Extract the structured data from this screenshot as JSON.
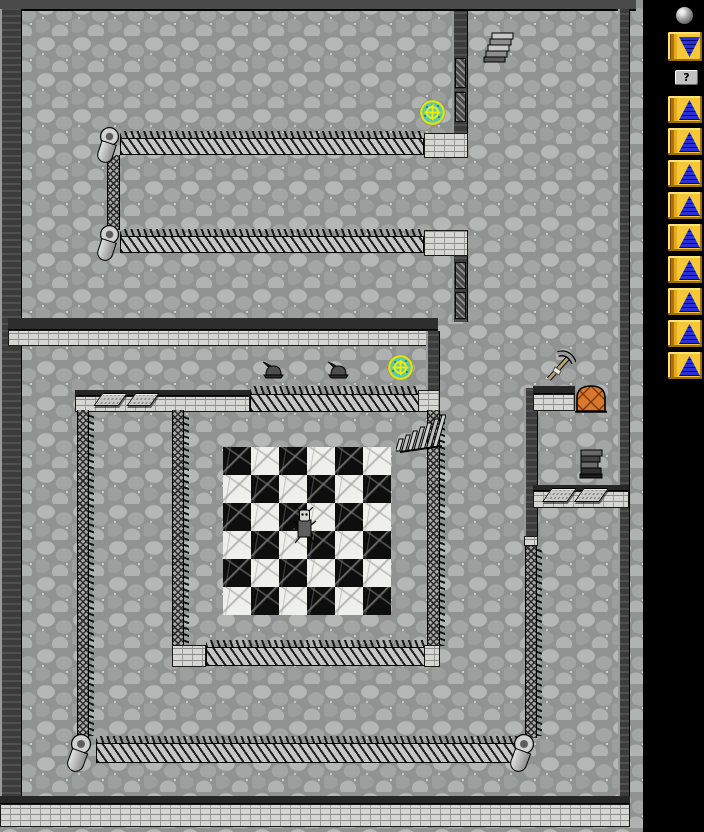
{
  "window": {
    "canvas_w": 704,
    "canvas_h": 832,
    "background": "#000000"
  },
  "sidebar": {
    "orb_icon": "stone-orb-icon",
    "descend_button": {
      "icon": "pyramid-down-icon"
    },
    "help_button": {
      "label": "?"
    },
    "spell_buttons": [
      {
        "icon": "pyramid-up-icon"
      },
      {
        "icon": "pyramid-up-icon"
      },
      {
        "icon": "pyramid-up-icon"
      },
      {
        "icon": "pyramid-up-icon"
      },
      {
        "icon": "pyramid-up-icon"
      },
      {
        "icon": "pyramid-up-icon"
      },
      {
        "icon": "pyramid-up-icon"
      },
      {
        "icon": "pyramid-up-icon"
      },
      {
        "icon": "pyramid-up-icon"
      }
    ]
  },
  "map": {
    "floor_texture": "cobblestone",
    "checkerboard": {
      "cols": 6,
      "rows": 6,
      "tile_px": 28,
      "first_tile": "black",
      "tile_colors": {
        "black": "#0e0e0e",
        "white": "#efefec"
      }
    },
    "items": [
      {
        "type": "stairs-down",
        "area": "top-right"
      },
      {
        "type": "portal-rune",
        "area": "upper-room"
      },
      {
        "type": "portal-rune",
        "area": "mid-corridor"
      },
      {
        "type": "helmet",
        "area": "mid-corridor-west"
      },
      {
        "type": "helmet",
        "area": "mid-corridor-east"
      },
      {
        "type": "ladder-up",
        "area": "inner-room-northeast"
      },
      {
        "type": "creature",
        "area": "checkerboard-center"
      },
      {
        "type": "pickaxe",
        "area": "east-room"
      },
      {
        "type": "wooden-door",
        "area": "east-room"
      },
      {
        "type": "dark-stairs",
        "area": "east-room"
      },
      {
        "type": "plate",
        "area": "west-wall-top-1"
      },
      {
        "type": "plate",
        "area": "west-wall-top-2"
      },
      {
        "type": "plate",
        "area": "east-wall-1"
      },
      {
        "type": "plate",
        "area": "east-wall-2"
      }
    ],
    "colors": {
      "floor": "#8f9492",
      "wall_dark": "#3c3c3c",
      "wall_brick": "#d6d6d2",
      "portal_ring": "#ece800",
      "portal_fill": "#55c8bc",
      "door_orange": "#d8782c",
      "button_gold": "#f0c028",
      "pyramid_blue": "#2830d8"
    }
  }
}
